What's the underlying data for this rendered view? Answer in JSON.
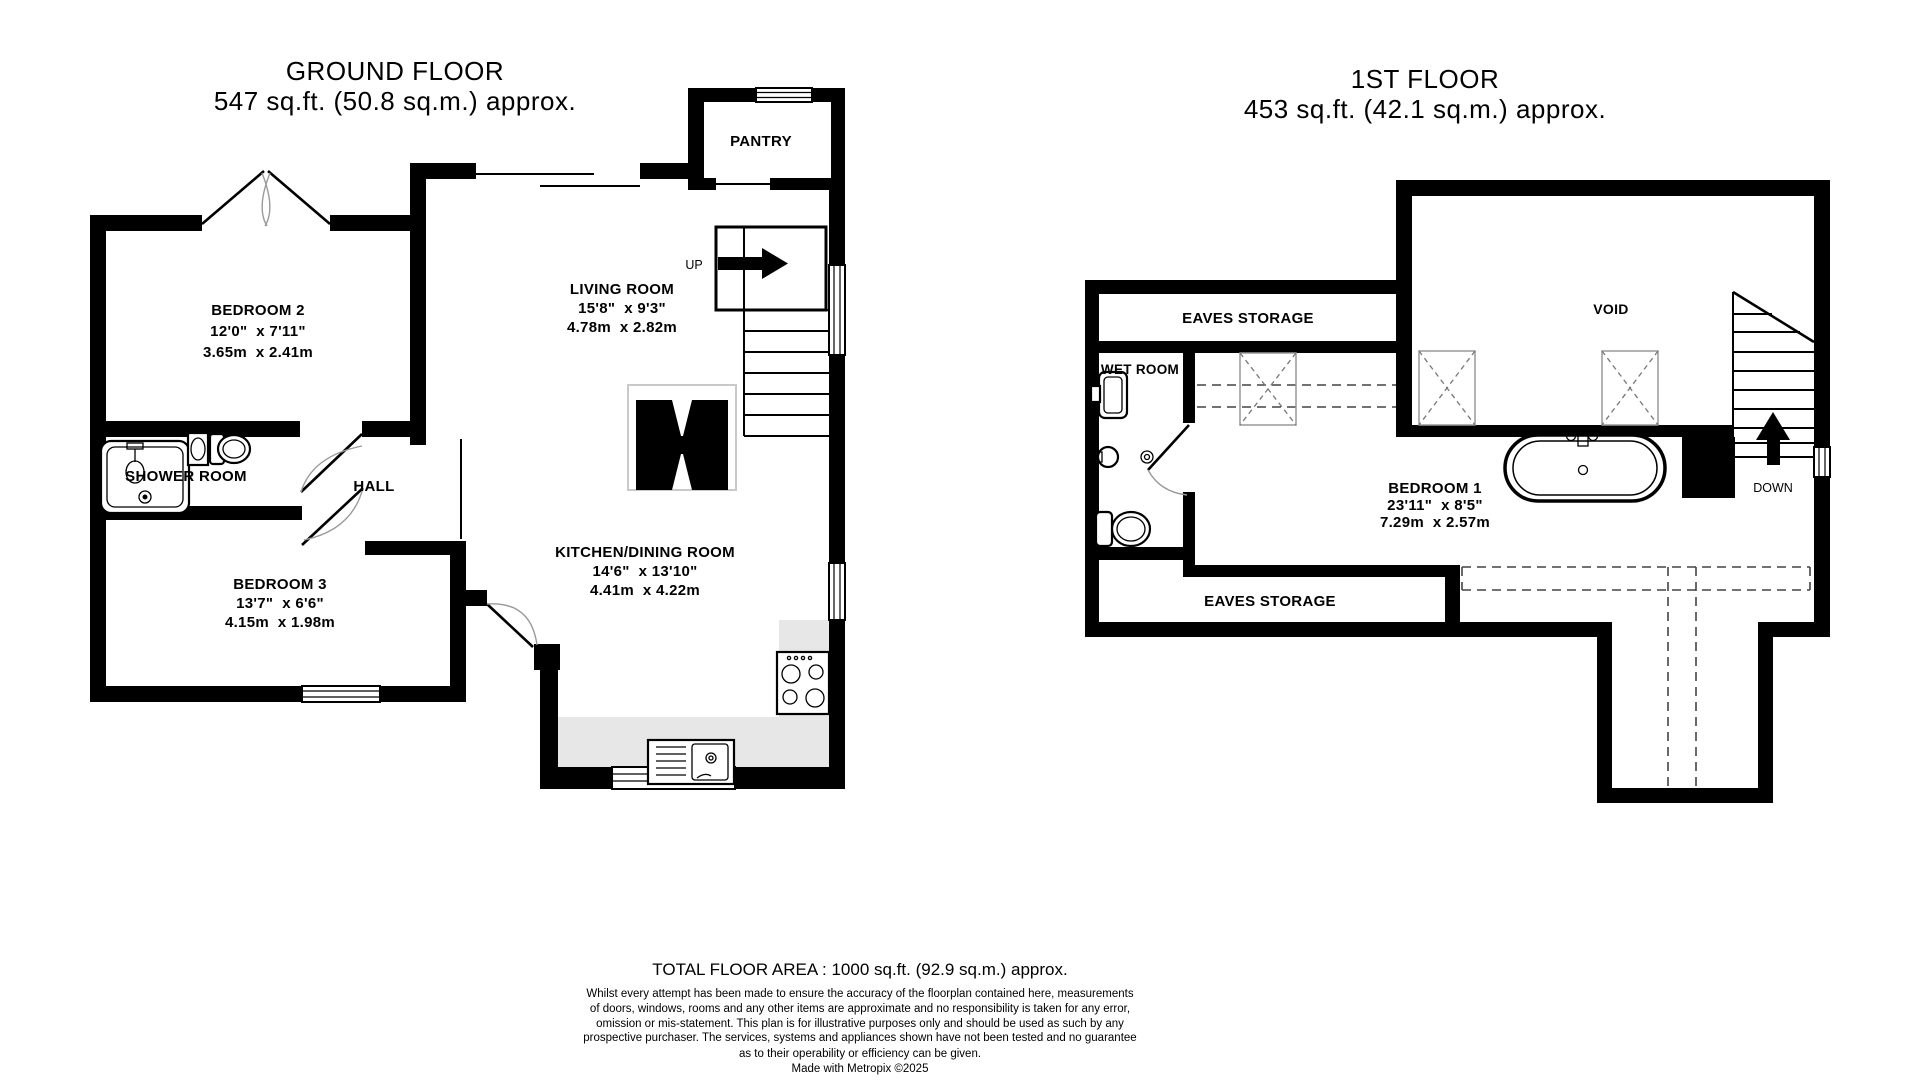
{
  "colors": {
    "wall": "#000000",
    "counter": "#e7e7e7",
    "background": "#ffffff"
  },
  "ground_floor": {
    "title": "GROUND FLOOR",
    "area": "547 sq.ft. (50.8 sq.m.) approx.",
    "rooms": {
      "bedroom2": {
        "name": "BEDROOM 2",
        "imperial": "12'0\"  x 7'11\"",
        "metric": "3.65m  x 2.41m"
      },
      "living_room": {
        "name": "LIVING ROOM",
        "imperial": "15'8\"  x 9'3\"",
        "metric": "4.78m  x 2.82m"
      },
      "kitchen": {
        "name": "KITCHEN/DINING ROOM",
        "imperial": "14'6\"  x 13'10\"",
        "metric": "4.41m  x 4.22m"
      },
      "bedroom3": {
        "name": "BEDROOM 3",
        "imperial": "13'7\"  x 6'6\"",
        "metric": "4.15m  x 1.98m"
      },
      "shower_room": {
        "name": "SHOWER ROOM"
      },
      "hall": {
        "name": "HALL"
      },
      "pantry": {
        "name": "PANTRY"
      }
    },
    "stairs_label": "UP"
  },
  "first_floor": {
    "title": "1ST FLOOR",
    "area": "453 sq.ft. (42.1 sq.m.) approx.",
    "rooms": {
      "bedroom1": {
        "name": "BEDROOM 1",
        "imperial": "23'11\"  x 8'5\"",
        "metric": "7.29m  x 2.57m"
      },
      "eaves_storage_top": {
        "name": "EAVES STORAGE"
      },
      "eaves_storage_bottom": {
        "name": "EAVES STORAGE"
      },
      "wet_room": {
        "name": "WET ROOM"
      },
      "void": {
        "name": "VOID"
      }
    },
    "stairs_label": "DOWN"
  },
  "footer": {
    "total_area": "TOTAL FLOOR AREA : 1000 sq.ft. (92.9 sq.m.) approx.",
    "disclaimer_lines": [
      "Whilst every attempt has been made to ensure the accuracy of the floorplan contained here, measurements",
      "of doors, windows, rooms and any other items are approximate and no responsibility is taken for any error,",
      "omission or mis-statement. This plan is for illustrative purposes only and should be used as such by any",
      "prospective purchaser. The services, systems and appliances shown have not been tested and no guarantee",
      "as to their operability or efficiency can be given."
    ],
    "credit": "Made with Metropix ©2025"
  }
}
